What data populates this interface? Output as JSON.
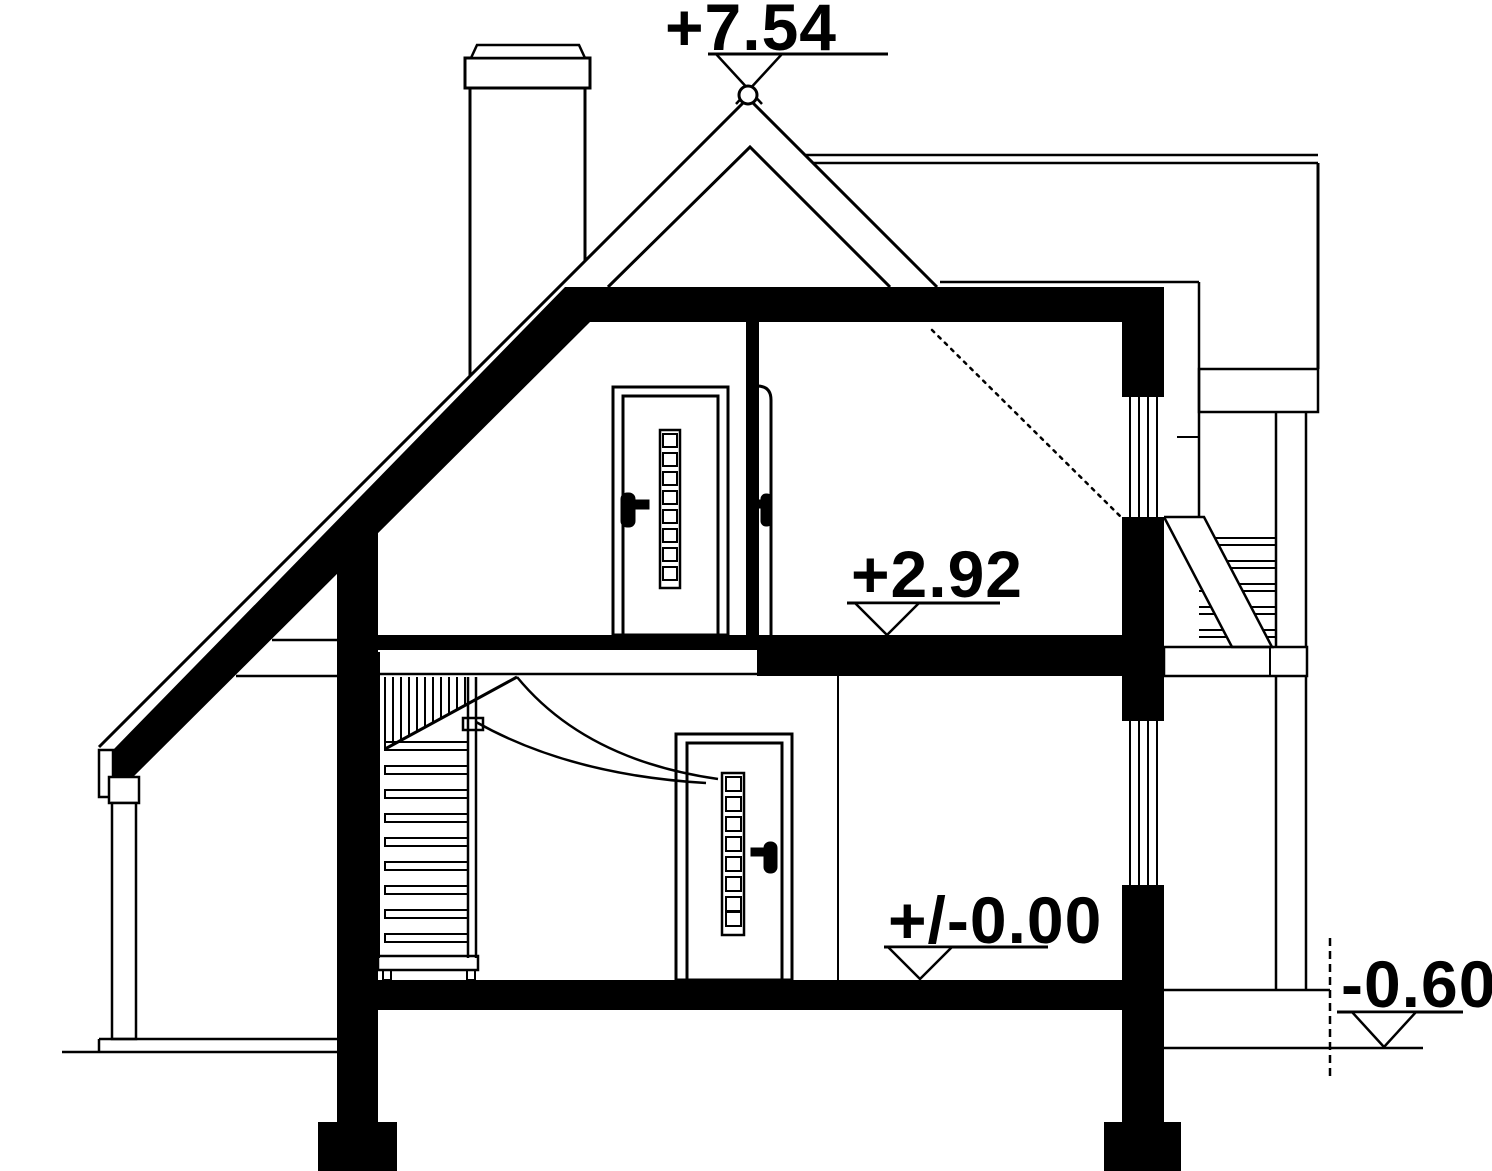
{
  "drawing": {
    "kind": "architectural-cross-section",
    "colors": {
      "line": "#000000",
      "cut_fill": "#000000",
      "background": "#ffffff"
    }
  },
  "markers": {
    "roof_peak": {
      "label": "+7.54"
    },
    "upper_floor": {
      "label": "+2.92"
    },
    "ground_floor": {
      "label": "+/-0.00"
    },
    "terrain": {
      "label": "-0.60"
    }
  }
}
